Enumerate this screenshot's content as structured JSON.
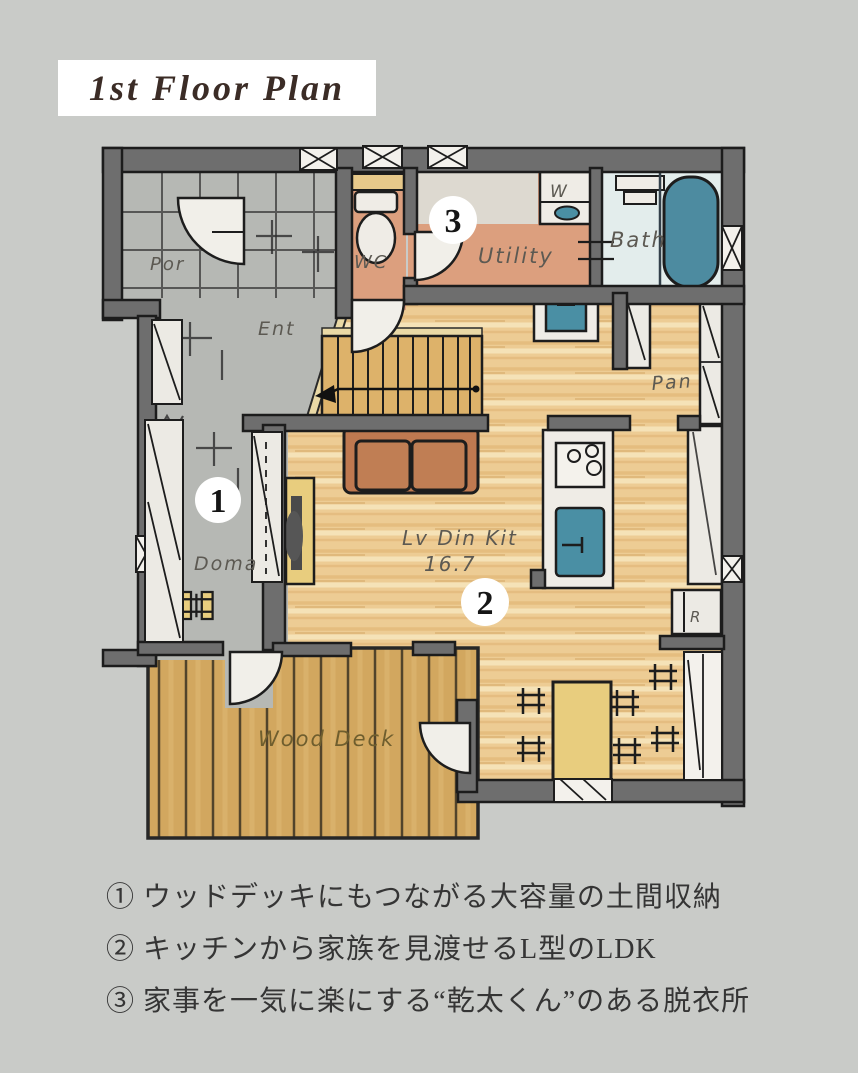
{
  "title": "1st Floor Plan",
  "plan": {
    "room_labels": {
      "porch": "Por",
      "entrance": "Ent",
      "wc": "WC",
      "utility": "Utility",
      "bath": "Bath",
      "washer": "W",
      "pantry": "Pan",
      "ldk_name": "Lv Din Kit",
      "ldk_area": "16.7",
      "doma": "Doma",
      "wood_deck": "Wood Deck",
      "refrigerator": "R"
    },
    "markers": {
      "one": "1",
      "two": "2",
      "three": "3"
    }
  },
  "notes": [
    "① ウッドデッキにもつながる大容量の土間収納",
    "② キッチンから家族を見渡せるL型のLDK",
    "③ 家事を一気に楽にする“乾太くん”のある脱衣所"
  ],
  "colors": {
    "background": "#c9cbc8",
    "wall": "#6e6e6e",
    "wood_floor": "#edcc94",
    "wood_deck": "#d2a75f",
    "entry_gray": "#b6b8b4",
    "salmon": "#dc9f7e",
    "bath_floor": "#e3edec",
    "fixture_teal": "#4a8fa4",
    "furniture_yellow": "#e8cd7e",
    "sofa": "#bf7950",
    "label": "#5c5952",
    "note_text": "#353535",
    "title_text": "#3b2c26"
  }
}
